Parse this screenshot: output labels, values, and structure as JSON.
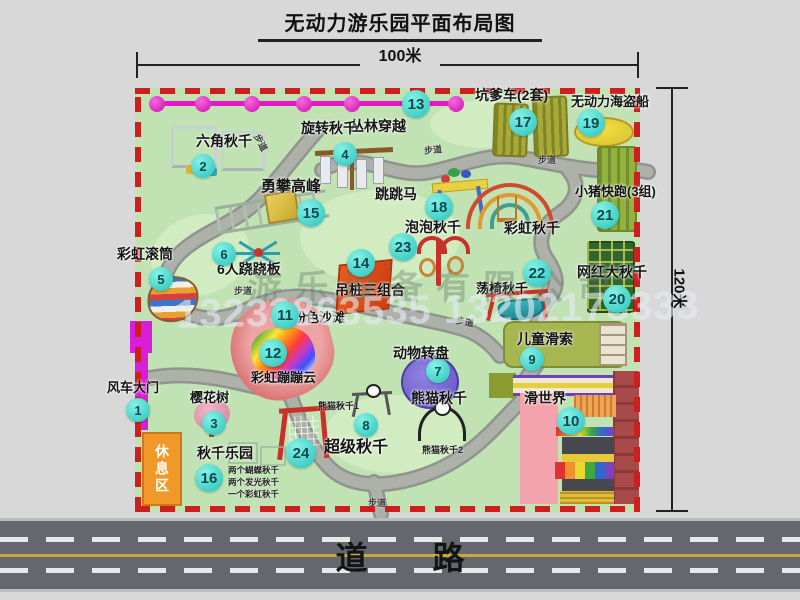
{
  "title": "无动力游乐园平面布局图",
  "dimensions": {
    "width": "100米",
    "height": "120米"
  },
  "road": {
    "label": "道 路"
  },
  "watermarks": {
    "company": "游乐设备有限公司",
    "phone": "13233863535 13202178333"
  },
  "labels": {
    "path": "步道",
    "rest_area": "休息区",
    "rainbow_swing": "彩虹秋千",
    "panda_swing_1": "熊猫秋千1",
    "panda_swing_2": "熊猫秋千2"
  },
  "attractions": [
    {
      "num": "1",
      "label": "风车大门"
    },
    {
      "num": "2",
      "label": "六角秋千"
    },
    {
      "num": "3",
      "label": "樱花树"
    },
    {
      "num": "4",
      "label": "旋转秋千"
    },
    {
      "num": "5",
      "label": "彩虹滚筒"
    },
    {
      "num": "6",
      "label": "6人跷跷板"
    },
    {
      "num": "7",
      "label": "动物转盘"
    },
    {
      "num": "8",
      "label": "熊猫秋千"
    },
    {
      "num": "9",
      "label": "儿童滑索"
    },
    {
      "num": "10",
      "label": "滑世界"
    },
    {
      "num": "11",
      "label": "粉色沙滩"
    },
    {
      "num": "12",
      "label": "彩虹蹦蹦云"
    },
    {
      "num": "13",
      "label": "丛林穿越"
    },
    {
      "num": "14",
      "label": "吊桩三组合"
    },
    {
      "num": "15",
      "label": "勇攀高峰"
    },
    {
      "num": "16",
      "label": "秋千乐园",
      "notes": [
        "两个蝴蝶秋千",
        "两个发光秋千",
        "一个彩虹秋千"
      ]
    },
    {
      "num": "17",
      "label": "坑爹车(2套)"
    },
    {
      "num": "18",
      "label": "跳跳马"
    },
    {
      "num": "19",
      "label": "无动力海盗船"
    },
    {
      "num": "20",
      "label": "网红大秋千"
    },
    {
      "num": "21",
      "label": "小猪快跑(3组)"
    },
    {
      "num": "22",
      "label": "荡椅秋千"
    },
    {
      "num": "23",
      "label": "泡泡秋千"
    },
    {
      "num": "24",
      "label": "超级秋千"
    }
  ],
  "colors": {
    "map_green": "#c1e2b3",
    "border_red": "#ce1f1f",
    "badge_cyan": "#27c2ba",
    "fence_magenta": "#e318c9",
    "gate_magenta": "#d81fd8",
    "rest_area_orange": "#f09828",
    "road_gray": "#65676f",
    "road_line_yellow": "#c8aa3a"
  }
}
